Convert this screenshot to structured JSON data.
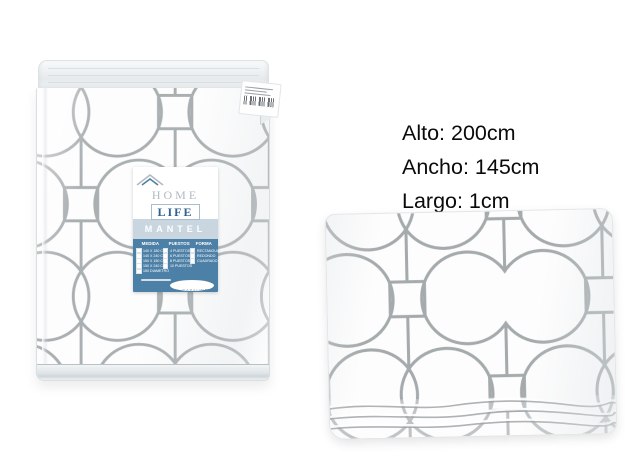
{
  "scene": {
    "description": "Product photo of a HOME LIFE tablecloth (mantel): packaged in clear plastic bag on the left, folded tablecloth on the right, dimensions text at top right",
    "background": "#ffffff"
  },
  "dimensions_text": {
    "line1": "Alto: 200cm",
    "line2": "Ancho: 145cm",
    "line3": "Largo: 1cm"
  },
  "package_label": {
    "brand_line1": "HOME",
    "brand_line2": "LIFE",
    "product_name": "MANTEL",
    "spec_columns": [
      {
        "header": "MEDIDA",
        "options": [
          "140 X 180 CM",
          "140 X 240 CM",
          "150 X 150 CM",
          "150 X 240 CM",
          "150 DIAMETRO"
        ]
      },
      {
        "header": "PUESTOS",
        "options": [
          "4 PUESTOS",
          "6 PUESTOS",
          "8 PUESTOS",
          "10 PUESTOS"
        ]
      },
      {
        "header": "FORMA",
        "options": [
          "RECTANGULAR",
          "REDONDO",
          "CUADRADO"
        ]
      }
    ],
    "maker_badge": "CASALINDA"
  },
  "colors": {
    "pattern_line": "#9ba1a4",
    "label_blue": "#4d80a6",
    "band_blue": "#c9d6df",
    "brand_blue": "#2e6091",
    "brand_gray": "#b3bac0",
    "text_black": "#0a0a0a"
  }
}
